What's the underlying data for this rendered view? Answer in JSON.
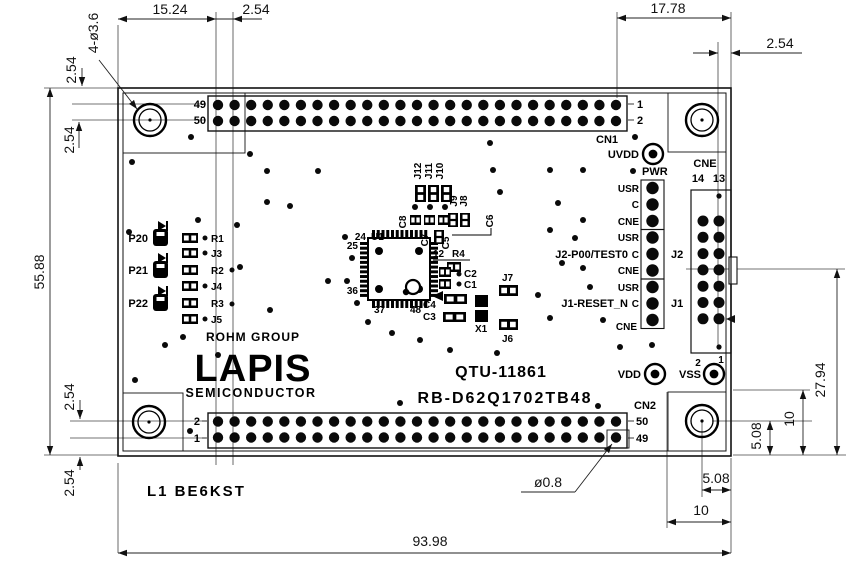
{
  "colors": {
    "ink": "#111111",
    "paper": "#ffffff"
  },
  "dims": {
    "top_left_width": "15.24",
    "top_left_pitch": "2.54",
    "top_right_width": "17.78",
    "top_right_pitch": "2.54",
    "left_edge_pitch_top": "2.54",
    "left_row_pitch_top": "2.54",
    "board_height": "55.88",
    "left_row_pitch_bottom": "2.54",
    "left_edge_pitch_bottom": "2.54",
    "mounting_holes": "4-ø3.6",
    "board_width": "93.98",
    "pin_hole_dia": "ø0.8",
    "hole_offset_x": "5.08",
    "hole_corner_x": "10",
    "hole_offset_y": "5.08",
    "hole_corner_y": "10",
    "cne_center_height": "27.94"
  },
  "cn1": {
    "label": "CN1",
    "pin_left_top": "49",
    "pin_left_bottom": "50",
    "pin_right_top": "1",
    "pin_right_bottom": "2"
  },
  "cn2": {
    "label": "CN2",
    "pin_left_top": "2",
    "pin_left_bottom": "1",
    "pin_right_top": "50",
    "pin_right_bottom": "49"
  },
  "cne": {
    "label": "CNE",
    "pin14": "14",
    "pin13": "13"
  },
  "power": {
    "uvdd": "UVDD",
    "pwr": "PWR",
    "vdd": "VDD",
    "vss": "VSS",
    "vss_pin2": "2",
    "vss_pin1": "1"
  },
  "jumpers": {
    "rows": [
      "USR",
      "C",
      "CNE",
      "USR",
      "C",
      "CNE",
      "USR",
      "C",
      "CNE"
    ],
    "j2_label": "J2",
    "j1_label": "J1",
    "j2_note": "J2-P00/TEST0",
    "j1_note": "J1-RESET_N"
  },
  "leds": {
    "p20": "P20",
    "p21": "P21",
    "p22": "P22",
    "r1": "R1",
    "j3": "J3",
    "r2": "R2",
    "j4": "J4",
    "r3": "R3",
    "j5": "J5"
  },
  "logo": {
    "group": "ROHM GROUP",
    "brand": "LAPIS",
    "sub": "SEMICONDUCTOR"
  },
  "titles": {
    "part_no": "QTU-11861",
    "board_no": "RB-D62Q1702TB48",
    "bottom_note": "L1 BE6KST"
  },
  "ic": {
    "ref": "U1",
    "pin24": "24",
    "pin25": "25",
    "pin36": "36",
    "pin37": "37",
    "pin48": "48",
    "pin12": "12"
  },
  "parts": {
    "j12": "J12",
    "j11": "J11",
    "j10": "J10",
    "j9": "J9",
    "j8": "J8",
    "c8": "C8",
    "c7": "C7",
    "c6": "C6",
    "c5": "C5",
    "r4": "R4",
    "c2": "C2",
    "c1": "C1",
    "c4": "C4",
    "c3": "C3",
    "x1": "X1",
    "j7": "J7",
    "j6": "J6"
  }
}
